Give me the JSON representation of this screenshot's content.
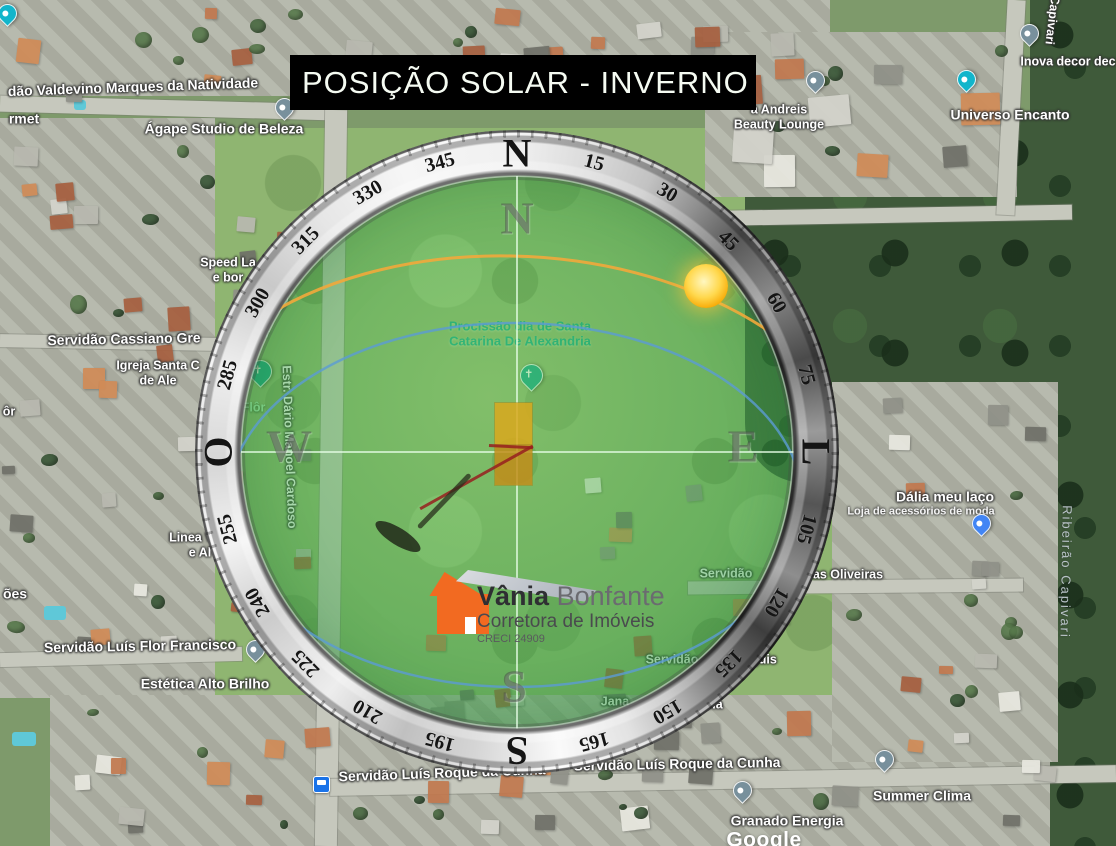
{
  "title": {
    "text": "POSIÇÃO SOLAR - INVERNO"
  },
  "logo": {
    "name": "Vânia",
    "surname": "Bonfante",
    "tagline": "Corretora de Imóveis",
    "creci": "CRECI 24909"
  },
  "colors": {
    "banner_bg": "#000000",
    "banner_text": "#f5fbf2",
    "sun": "#fdb813",
    "sun_path_orange": "#f2a93b",
    "sky_circle_blue": "#5b9bd5",
    "lot_fill": "#d0a21d",
    "overlay_green": "#3aa046",
    "logo_orange": "#f26a21",
    "logo_gray_roof": "#b9bdc4",
    "pin_gray": "#78909c",
    "pin_teal": "#12b5cb",
    "pin_blue": "#4285f4",
    "pin_church": "#0fa38a",
    "pin_green": "#34a853",
    "bus_blue": "#1a73e8"
  },
  "compass": {
    "ring_labels": [
      {
        "deg": 0,
        "text": "N",
        "cardinal": true
      },
      {
        "deg": 15,
        "text": "15"
      },
      {
        "deg": 30,
        "text": "30"
      },
      {
        "deg": 45,
        "text": "45"
      },
      {
        "deg": 60,
        "text": "60"
      },
      {
        "deg": 75,
        "text": "75"
      },
      {
        "deg": 90,
        "text": "L",
        "cardinal": true
      },
      {
        "deg": 105,
        "text": "105"
      },
      {
        "deg": 120,
        "text": "120"
      },
      {
        "deg": 135,
        "text": "135"
      },
      {
        "deg": 150,
        "text": "150"
      },
      {
        "deg": 165,
        "text": "165"
      },
      {
        "deg": 180,
        "text": "S",
        "cardinal": true
      },
      {
        "deg": 195,
        "text": "195"
      },
      {
        "deg": 210,
        "text": "210"
      },
      {
        "deg": 225,
        "text": "225"
      },
      {
        "deg": 240,
        "text": "240"
      },
      {
        "deg": 255,
        "text": "255"
      },
      {
        "deg": 270,
        "text": "O",
        "cardinal": true
      },
      {
        "deg": 285,
        "text": "285"
      },
      {
        "deg": 300,
        "text": "300"
      },
      {
        "deg": 315,
        "text": "315"
      },
      {
        "deg": 330,
        "text": "330"
      },
      {
        "deg": 345,
        "text": "345"
      }
    ],
    "inner_letters": [
      {
        "text": "N",
        "x": 517,
        "y": 218
      },
      {
        "text": "E",
        "x": 743,
        "y": 446
      },
      {
        "text": "S",
        "x": 514,
        "y": 686
      },
      {
        "text": "W",
        "x": 289,
        "y": 446
      }
    ]
  },
  "map_labels": [
    {
      "name": "street-valdevino",
      "text": "dão Valdevino Marques da Natividade",
      "x": 133,
      "y": 87,
      "kind": "street-lg",
      "rot": -2,
      "i": false
    },
    {
      "name": "poi-rmet",
      "text": "rmet",
      "x": 24,
      "y": 119,
      "kind": "street-lg",
      "rot": 0,
      "i": false
    },
    {
      "name": "poi-agape",
      "text": "Ágape Studio de Beleza",
      "x": 224,
      "y": 129,
      "kind": "poi-lg",
      "rot": 0,
      "i": true
    },
    {
      "name": "poi-andreis",
      "text": "a Andreis\nBeauty Lounge",
      "x": 779,
      "y": 117,
      "kind": "poi",
      "rot": 0,
      "i": true
    },
    {
      "name": "poi-universo-encanto",
      "text": "Universo Encanto",
      "x": 1010,
      "y": 115,
      "kind": "poi-lg",
      "rot": 0,
      "i": true
    },
    {
      "name": "poi-inova-decor",
      "text": "Inova decor dec",
      "x": 1068,
      "y": 62,
      "kind": "poi",
      "rot": 0,
      "i": true
    },
    {
      "name": "street-capivari-top",
      "text": "Capivari",
      "x": 1052,
      "y": 20,
      "kind": "street",
      "rot": 97,
      "i": false
    },
    {
      "name": "poi-speed",
      "text": "Speed La\ne bor",
      "x": 228,
      "y": 270,
      "kind": "poi",
      "rot": 0,
      "i": true
    },
    {
      "name": "street-cassiano",
      "text": "Servidão Cassiano Gre",
      "x": 124,
      "y": 339,
      "kind": "street-lg",
      "rot": -1,
      "i": false
    },
    {
      "name": "poi-igreja-santa",
      "text": "Igreja Santa C\nde Ale",
      "x": 158,
      "y": 373,
      "kind": "poi",
      "rot": 0,
      "i": true
    },
    {
      "name": "street-or",
      "text": "ôr",
      "x": 9,
      "y": 412,
      "kind": "street",
      "rot": 0,
      "i": false
    },
    {
      "name": "nature-lor",
      "text": "lor",
      "x": 262,
      "y": 334,
      "kind": "nature",
      "rot": 0,
      "i": true
    },
    {
      "name": "nature-o-flor",
      "text": "o Flôr",
      "x": 248,
      "y": 408,
      "kind": "nature",
      "rot": 0,
      "i": true
    },
    {
      "name": "street-dario-cardoso",
      "text": "Estr. Dário Manoel Cardoso",
      "x": 289,
      "y": 447,
      "kind": "street",
      "rot": 88,
      "i": false
    },
    {
      "name": "poi-linea",
      "text": "Linea V   a\ne Al",
      "x": 200,
      "y": 545,
      "kind": "poi",
      "rot": 0,
      "i": true
    },
    {
      "name": "street-oes",
      "text": "ões",
      "x": 15,
      "y": 594,
      "kind": "street-lg",
      "rot": 0,
      "i": false
    },
    {
      "name": "street-luis-flor",
      "text": "Servidão Luís Flor Francisco",
      "x": 140,
      "y": 646,
      "kind": "street-lg",
      "rot": -1,
      "i": false
    },
    {
      "name": "poi-estetica",
      "text": "Estética Alto Brilho",
      "x": 205,
      "y": 684,
      "kind": "poi-lg",
      "rot": 0,
      "i": true
    },
    {
      "name": "event-procissao",
      "text": "Procissão dia de Santa\nCatarina De Alexandria",
      "x": 520,
      "y": 334,
      "kind": "teal",
      "rot": 0,
      "i": true
    },
    {
      "name": "street-oliveiras-a",
      "text": "Servidão",
      "x": 726,
      "y": 574,
      "kind": "street",
      "rot": 0,
      "i": false
    },
    {
      "name": "street-oliveiras-b",
      "text": "as Oliveiras",
      "x": 848,
      "y": 575,
      "kind": "street",
      "rot": 0,
      "i": false
    },
    {
      "name": "street-guis-a",
      "text": "Servidão",
      "x": 672,
      "y": 660,
      "kind": "street",
      "rot": 0,
      "i": false
    },
    {
      "name": "street-guis-b",
      "text": "guis",
      "x": 764,
      "y": 660,
      "kind": "street",
      "rot": 0,
      "i": false
    },
    {
      "name": "poi-jana",
      "text": "Jana",
      "x": 615,
      "y": 702,
      "kind": "poi",
      "rot": 0,
      "i": true
    },
    {
      "name": "poi-sia",
      "text": "sia",
      "x": 714,
      "y": 705,
      "kind": "poi",
      "rot": 0,
      "i": true
    },
    {
      "name": "poi-dalia",
      "text": "Dália meu laço",
      "x": 945,
      "y": 497,
      "kind": "poi-lg",
      "rot": 0,
      "i": true
    },
    {
      "name": "poi-dalia-sub",
      "text": "Loja de acessórios de moda",
      "x": 921,
      "y": 512,
      "kind": "poi-sm",
      "rot": 0,
      "i": true
    },
    {
      "name": "water-ribeirao-capivari",
      "text": "Ribeirão Capivari",
      "x": 1066,
      "y": 572,
      "kind": "water",
      "rot": 91,
      "i": false
    },
    {
      "name": "street-roque-1",
      "text": "Servidão Luís Roque da Cunha",
      "x": 442,
      "y": 773,
      "kind": "street-lg",
      "rot": -2,
      "i": false
    },
    {
      "name": "street-roque-2",
      "text": "Servidão Luís Roque da Cunha",
      "x": 677,
      "y": 764,
      "kind": "street-lg",
      "rot": -1,
      "i": false
    },
    {
      "name": "poi-summer-clima",
      "text": "Summer Clima",
      "x": 922,
      "y": 796,
      "kind": "poi-lg",
      "rot": 0,
      "i": true
    },
    {
      "name": "poi-granado-energia",
      "text": "Granado Energia",
      "x": 787,
      "y": 821,
      "kind": "poi-lg",
      "rot": 0,
      "i": true
    },
    {
      "name": "google-watermark",
      "text": "Google",
      "x": 764,
      "y": 841,
      "kind": "brand",
      "rot": 0,
      "i": false
    }
  ],
  "pins": [
    {
      "name": "agape-pin",
      "x": 284,
      "y": 98,
      "kind": "place",
      "color": "#78909c"
    },
    {
      "name": "corner-pin",
      "x": 7,
      "y": 4,
      "kind": "place",
      "color": "#12b5cb"
    },
    {
      "name": "andreis-pin",
      "x": 815,
      "y": 71,
      "kind": "place",
      "color": "#78909c"
    },
    {
      "name": "inova-pin",
      "x": 1029,
      "y": 24,
      "kind": "place",
      "color": "#78909c"
    },
    {
      "name": "universo-pin",
      "x": 966,
      "y": 70,
      "kind": "place",
      "color": "#12b5cb"
    },
    {
      "name": "church-pin-1",
      "x": 258,
      "y": 360,
      "kind": "church",
      "color": "#0fa38a"
    },
    {
      "name": "church-pin-2",
      "x": 529,
      "y": 364,
      "kind": "church",
      "color": "#0fa38a"
    },
    {
      "name": "flor-pin",
      "x": 278,
      "y": 290,
      "kind": "place",
      "color": "#34a853"
    },
    {
      "name": "dalia-pin",
      "x": 981,
      "y": 514,
      "kind": "place",
      "color": "#4285f4"
    },
    {
      "name": "estetica-pin",
      "x": 255,
      "y": 640,
      "kind": "place",
      "color": "#78909c"
    },
    {
      "name": "summer-clima-pin",
      "x": 884,
      "y": 750,
      "kind": "place",
      "color": "#78909c"
    },
    {
      "name": "granado-pin",
      "x": 742,
      "y": 781,
      "kind": "place",
      "color": "#78909c"
    },
    {
      "name": "bus-stop-icon",
      "x": 322,
      "y": 776,
      "kind": "bus",
      "color": "#1a73e8"
    }
  ]
}
